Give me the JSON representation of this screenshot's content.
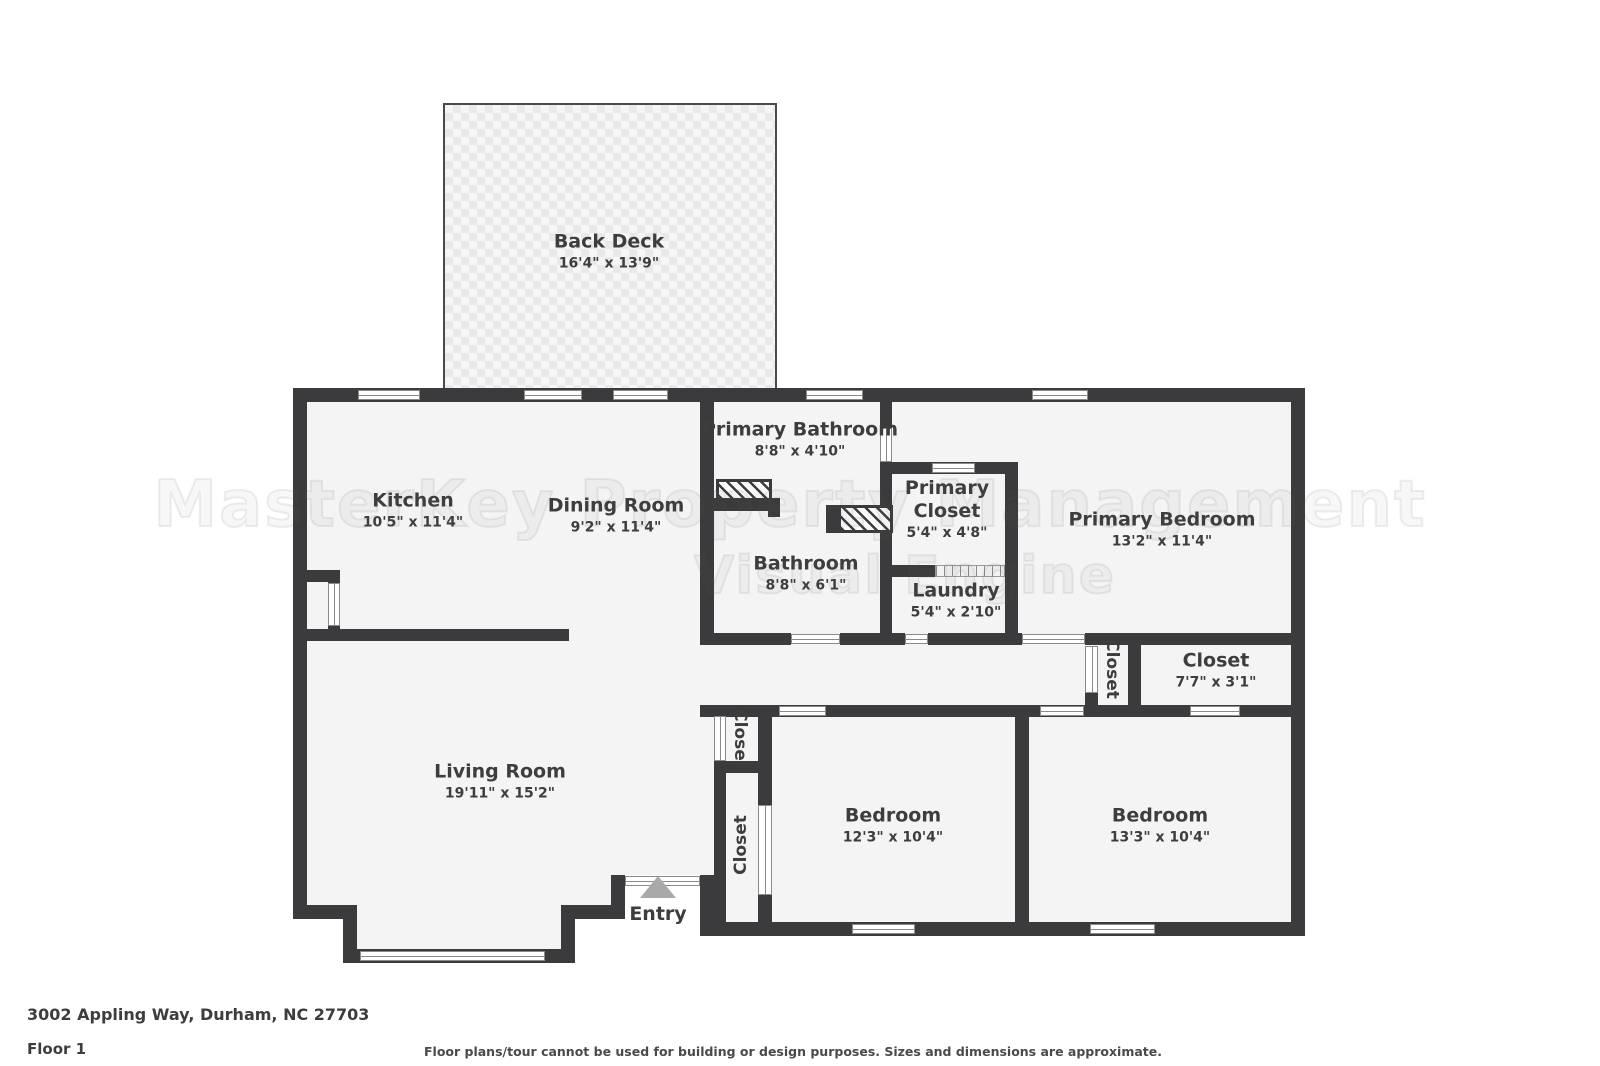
{
  "colors": {
    "wall": "#3b3b3d",
    "floor": "#f4f4f4",
    "deck_tile": "#e9e9e9",
    "label_text": "#3d3d3d",
    "entry_arrow": "#a9a9a9"
  },
  "floorplan": {
    "watermark": {
      "line1": "MasterKey Property Management",
      "line2": "Visual Engine"
    },
    "entry": {
      "label": "Entry"
    },
    "rooms": {
      "back_deck": {
        "name": "Back Deck",
        "dims": "16'4\" x 13'9\""
      },
      "kitchen": {
        "name": "Kitchen",
        "dims": "10'5\" x 11'4\""
      },
      "dining_room": {
        "name": "Dining Room",
        "dims": "9'2\" x 11'4\""
      },
      "primary_bathroom": {
        "name": "Primary Bathroom",
        "dims": "8'8\" x 4'10\""
      },
      "primary_closet": {
        "name_line1": "Primary",
        "name_line2": "Closet",
        "dims": "5'4\" x 4'8\""
      },
      "primary_bedroom": {
        "name": "Primary Bedroom",
        "dims": "13'2\" x 11'4\""
      },
      "bathroom": {
        "name": "Bathroom",
        "dims": "8'8\" x 6'1\""
      },
      "laundry": {
        "name": "Laundry",
        "dims": "5'4\" x 2'10\""
      },
      "hall_closet": {
        "name": "Closet"
      },
      "closet_right": {
        "name": "Closet",
        "dims": "7'7\" x 3'1\""
      },
      "entry_closet_upper": {
        "name": "Closet"
      },
      "entry_closet_lower": {
        "name": "Closet"
      },
      "living_room": {
        "name": "Living Room",
        "dims": "19'11\" x 15'2\""
      },
      "bedroom_1": {
        "name": "Bedroom",
        "dims": "12'3\" x 10'4\""
      },
      "bedroom_2": {
        "name": "Bedroom",
        "dims": "13'3\" x 10'4\""
      }
    }
  },
  "footer": {
    "address": "3002 Appling Way, Durham, NC 27703",
    "floor_label": "Floor 1",
    "disclaimer": "Floor plans/tour cannot be used for building or design purposes. Sizes and dimensions are approximate."
  }
}
